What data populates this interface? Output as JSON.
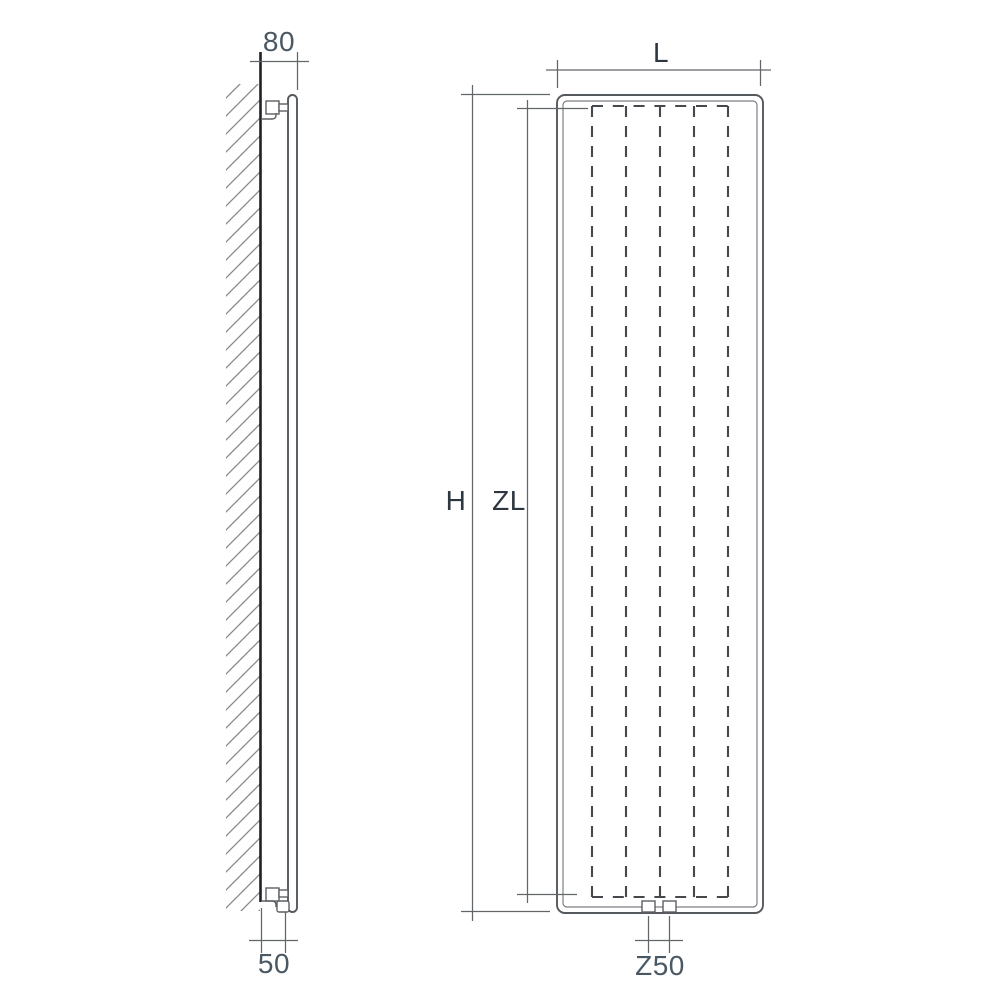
{
  "diagram": {
    "side_view": {
      "dim_top": {
        "label": "80"
      },
      "dim_bottom": {
        "label": "50"
      }
    },
    "front_view": {
      "dim_width": {
        "label": "L"
      },
      "dim_height": {
        "label": "H"
      },
      "dim_inner_height": {
        "label": "ZL"
      },
      "dim_connection": {
        "label": "Z50"
      }
    },
    "colors": {
      "background": "#ffffff",
      "outline": "#55585c",
      "wall_line": "#1f2124",
      "hatch": "#85898d",
      "dimension_line": "#626569",
      "hidden_dash": "#45484c",
      "number_text": "#4a5864",
      "letter_text": "#2e3640"
    }
  }
}
